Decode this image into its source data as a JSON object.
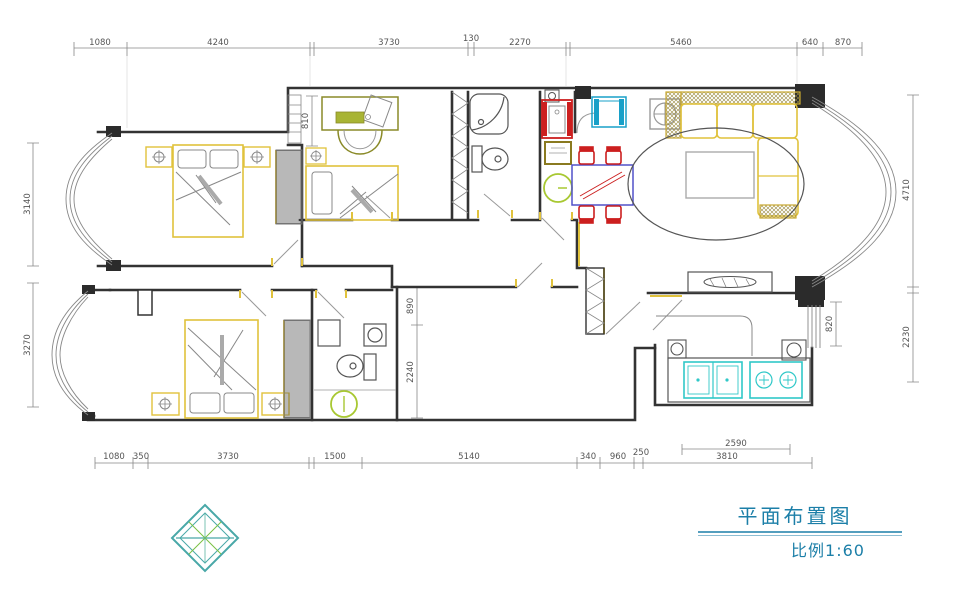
{
  "title_block": {
    "title": "平面布置图",
    "scale": "比例1:60"
  },
  "dims": {
    "top": [
      "1080",
      "4240",
      "3730",
      "130",
      "2270",
      "5460",
      "640",
      "870"
    ],
    "bottom": [
      "1080",
      "350",
      "3730",
      "1500",
      "5140",
      "340",
      "960",
      "250",
      "3810"
    ],
    "bottom_inner": "2590",
    "left": [
      "3140",
      "3270"
    ],
    "right": [
      "4710",
      "2230"
    ],
    "study_window": "810",
    "hall_width": "890",
    "hall_length": "2240",
    "kitchen_window": "820"
  },
  "colors": {
    "wall": "#333333",
    "dim_line": "#888888",
    "dim_text": "#555555",
    "accent_yellow": "#e0c23c",
    "accent_red": "#cc1f1f",
    "accent_blue": "#5050c8",
    "accent_teal_fridge": "#18a0c8",
    "accent_cyan": "#30c8c8",
    "accent_green": "#a8c832",
    "olive": "#8a8a28",
    "title_teal": "#1c7fa8",
    "logo_teal": "#49a8a8",
    "logo_green": "#7ac143"
  }
}
